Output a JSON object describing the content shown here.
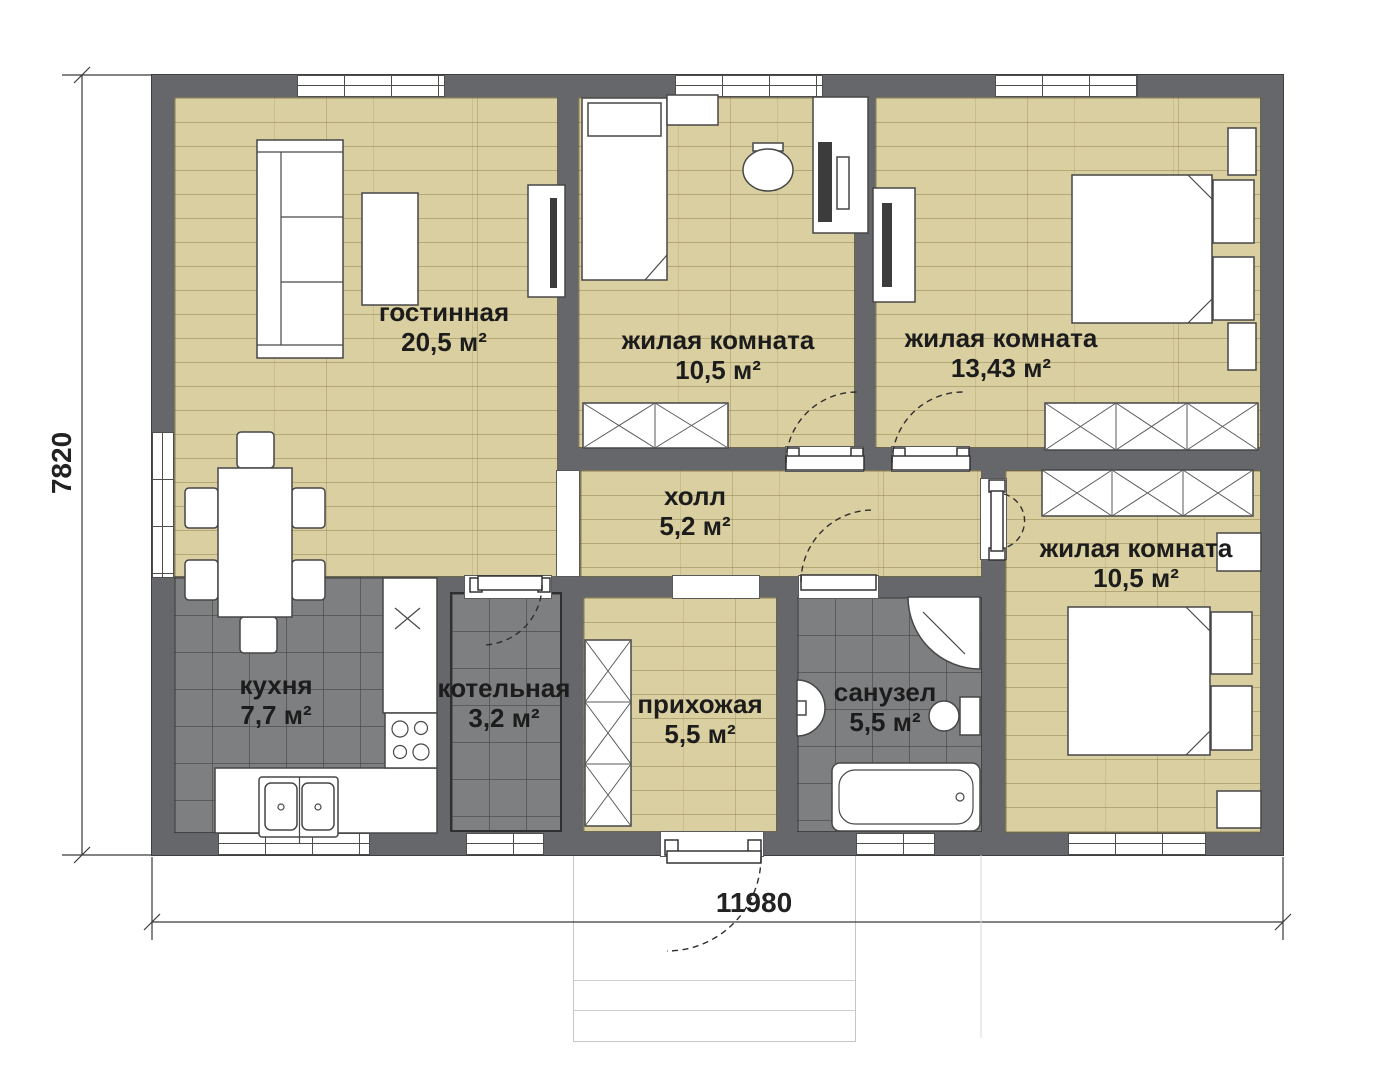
{
  "rooms": [
    {
      "name": "гостинная",
      "area": "20,5 м²"
    },
    {
      "name": "жилая комната",
      "area": "10,5 м²"
    },
    {
      "name": "жилая комната",
      "area": "13,43 м²"
    },
    {
      "name": "холл",
      "area": "5,2 м²"
    },
    {
      "name": "кухня",
      "area": "7,7 м²"
    },
    {
      "name": "котельная",
      "area": "3,2 м²"
    },
    {
      "name": "прихожая",
      "area": "5,5 м²"
    },
    {
      "name": "санузел",
      "area": "5,5 м²"
    },
    {
      "name": "жилая комната",
      "area": "10,5 м²"
    }
  ],
  "dimensions": {
    "overall_width": "11980",
    "overall_height": "7820"
  },
  "colors": {
    "wall": "#66676a",
    "wood_floor": "#dacfa0",
    "tile_floor": "#7e7f80",
    "furniture_outline": "#474747",
    "text": "#1c1c1c"
  }
}
